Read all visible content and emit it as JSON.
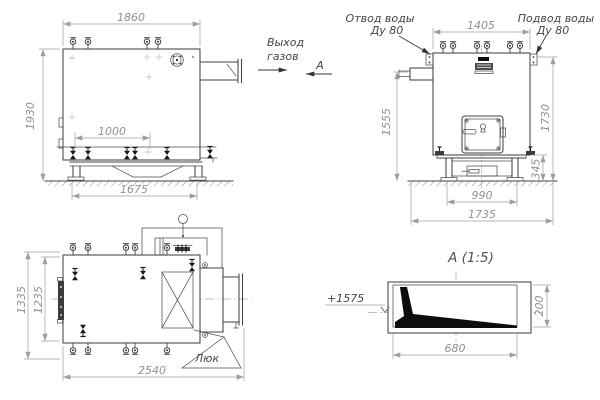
{
  "drawing_type": "boiler-technical-drawing",
  "colors": {
    "line": "#3f4347",
    "dim_line": "#98a0a6",
    "dim_text": "#8b9197",
    "label_text": "#41464b",
    "fill_black": "#0d0d0d",
    "background": "#ffffff"
  },
  "side_view": {
    "dim_width_top": "1860",
    "dim_height": "1930",
    "dim_support_span": "1000",
    "dim_base_width": "1675",
    "gas_outlet_line1": "Выход",
    "gas_outlet_line2": "газов",
    "section_label": "А"
  },
  "front_view": {
    "dim_width_top": "1405",
    "dim_height_left": "1555",
    "dim_height_right": "1730",
    "dim_base_height": "345",
    "dim_leg_span": "990",
    "dim_base_width": "1735",
    "water_outlet_line1": "Отвод воды",
    "water_outlet_line2": "Ду 80",
    "water_inlet_line1": "Подвод воды",
    "water_inlet_line2": "Ду 80"
  },
  "top_view": {
    "dim_height_outer": "1335",
    "dim_height_inner": "1235",
    "dim_length": "2540",
    "hatch_label": "Люк"
  },
  "detail_view": {
    "title": "А  (1:5)",
    "elevation_mark": "+1575",
    "dim_width": "680",
    "dim_height": "200"
  }
}
